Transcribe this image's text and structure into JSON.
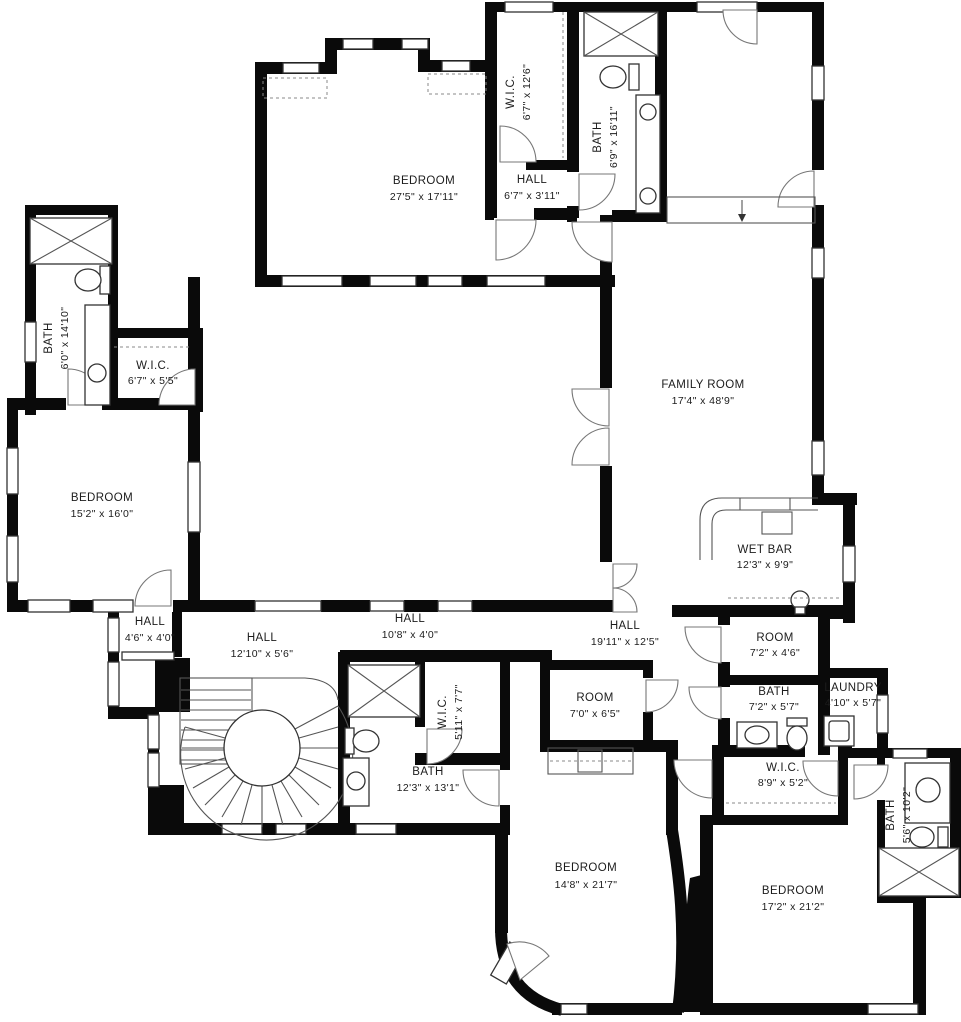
{
  "colors": {
    "wall": "#0a0a0a",
    "background": "#ffffff",
    "fixture_line": "#333333"
  },
  "rooms": [
    {
      "name": "BEDROOM",
      "dims": "27'5\" x 17'11\""
    },
    {
      "name": "W.I.C.",
      "dims": "6'7\" x 12'6\""
    },
    {
      "name": "HALL",
      "dims": "6'7\" x 3'11\""
    },
    {
      "name": "BATH",
      "dims": "6'9\" x 16'11\""
    },
    {
      "name": "BATH",
      "dims": "6'0\" x 14'10\""
    },
    {
      "name": "W.I.C.",
      "dims": "6'7\" x 5'5\""
    },
    {
      "name": "BEDROOM",
      "dims": "15'2\" x 16'0\""
    },
    {
      "name": "FAMILY ROOM",
      "dims": "17'4\" x 48'9\""
    },
    {
      "name": "WET BAR",
      "dims": "12'3\" x 9'9\""
    },
    {
      "name": "HALL",
      "dims": "4'6\" x 4'0\""
    },
    {
      "name": "HALL",
      "dims": "12'10\" x 5'6\""
    },
    {
      "name": "HALL",
      "dims": "10'8\" x 4'0\""
    },
    {
      "name": "HALL",
      "dims": "19'11\" x 12'5\""
    },
    {
      "name": "ROOM",
      "dims": "7'2\" x 4'6\""
    },
    {
      "name": "W.I.C.",
      "dims": "5'11\" x 7'7\""
    },
    {
      "name": "BATH",
      "dims": "12'3\" x 13'1\""
    },
    {
      "name": "ROOM",
      "dims": "7'0\" x 6'5\""
    },
    {
      "name": "BATH",
      "dims": "7'2\" x 5'7\""
    },
    {
      "name": "LAUNDRY",
      "dims": "4'10\" x 5'7\""
    },
    {
      "name": "W.I.C.",
      "dims": "8'9\" x 5'2\""
    },
    {
      "name": "BEDROOM",
      "dims": "14'8\" x 21'7\""
    },
    {
      "name": "BEDROOM",
      "dims": "17'2\" x 21'2\""
    },
    {
      "name": "BATH",
      "dims": "5'6\" x 10'2\""
    }
  ]
}
